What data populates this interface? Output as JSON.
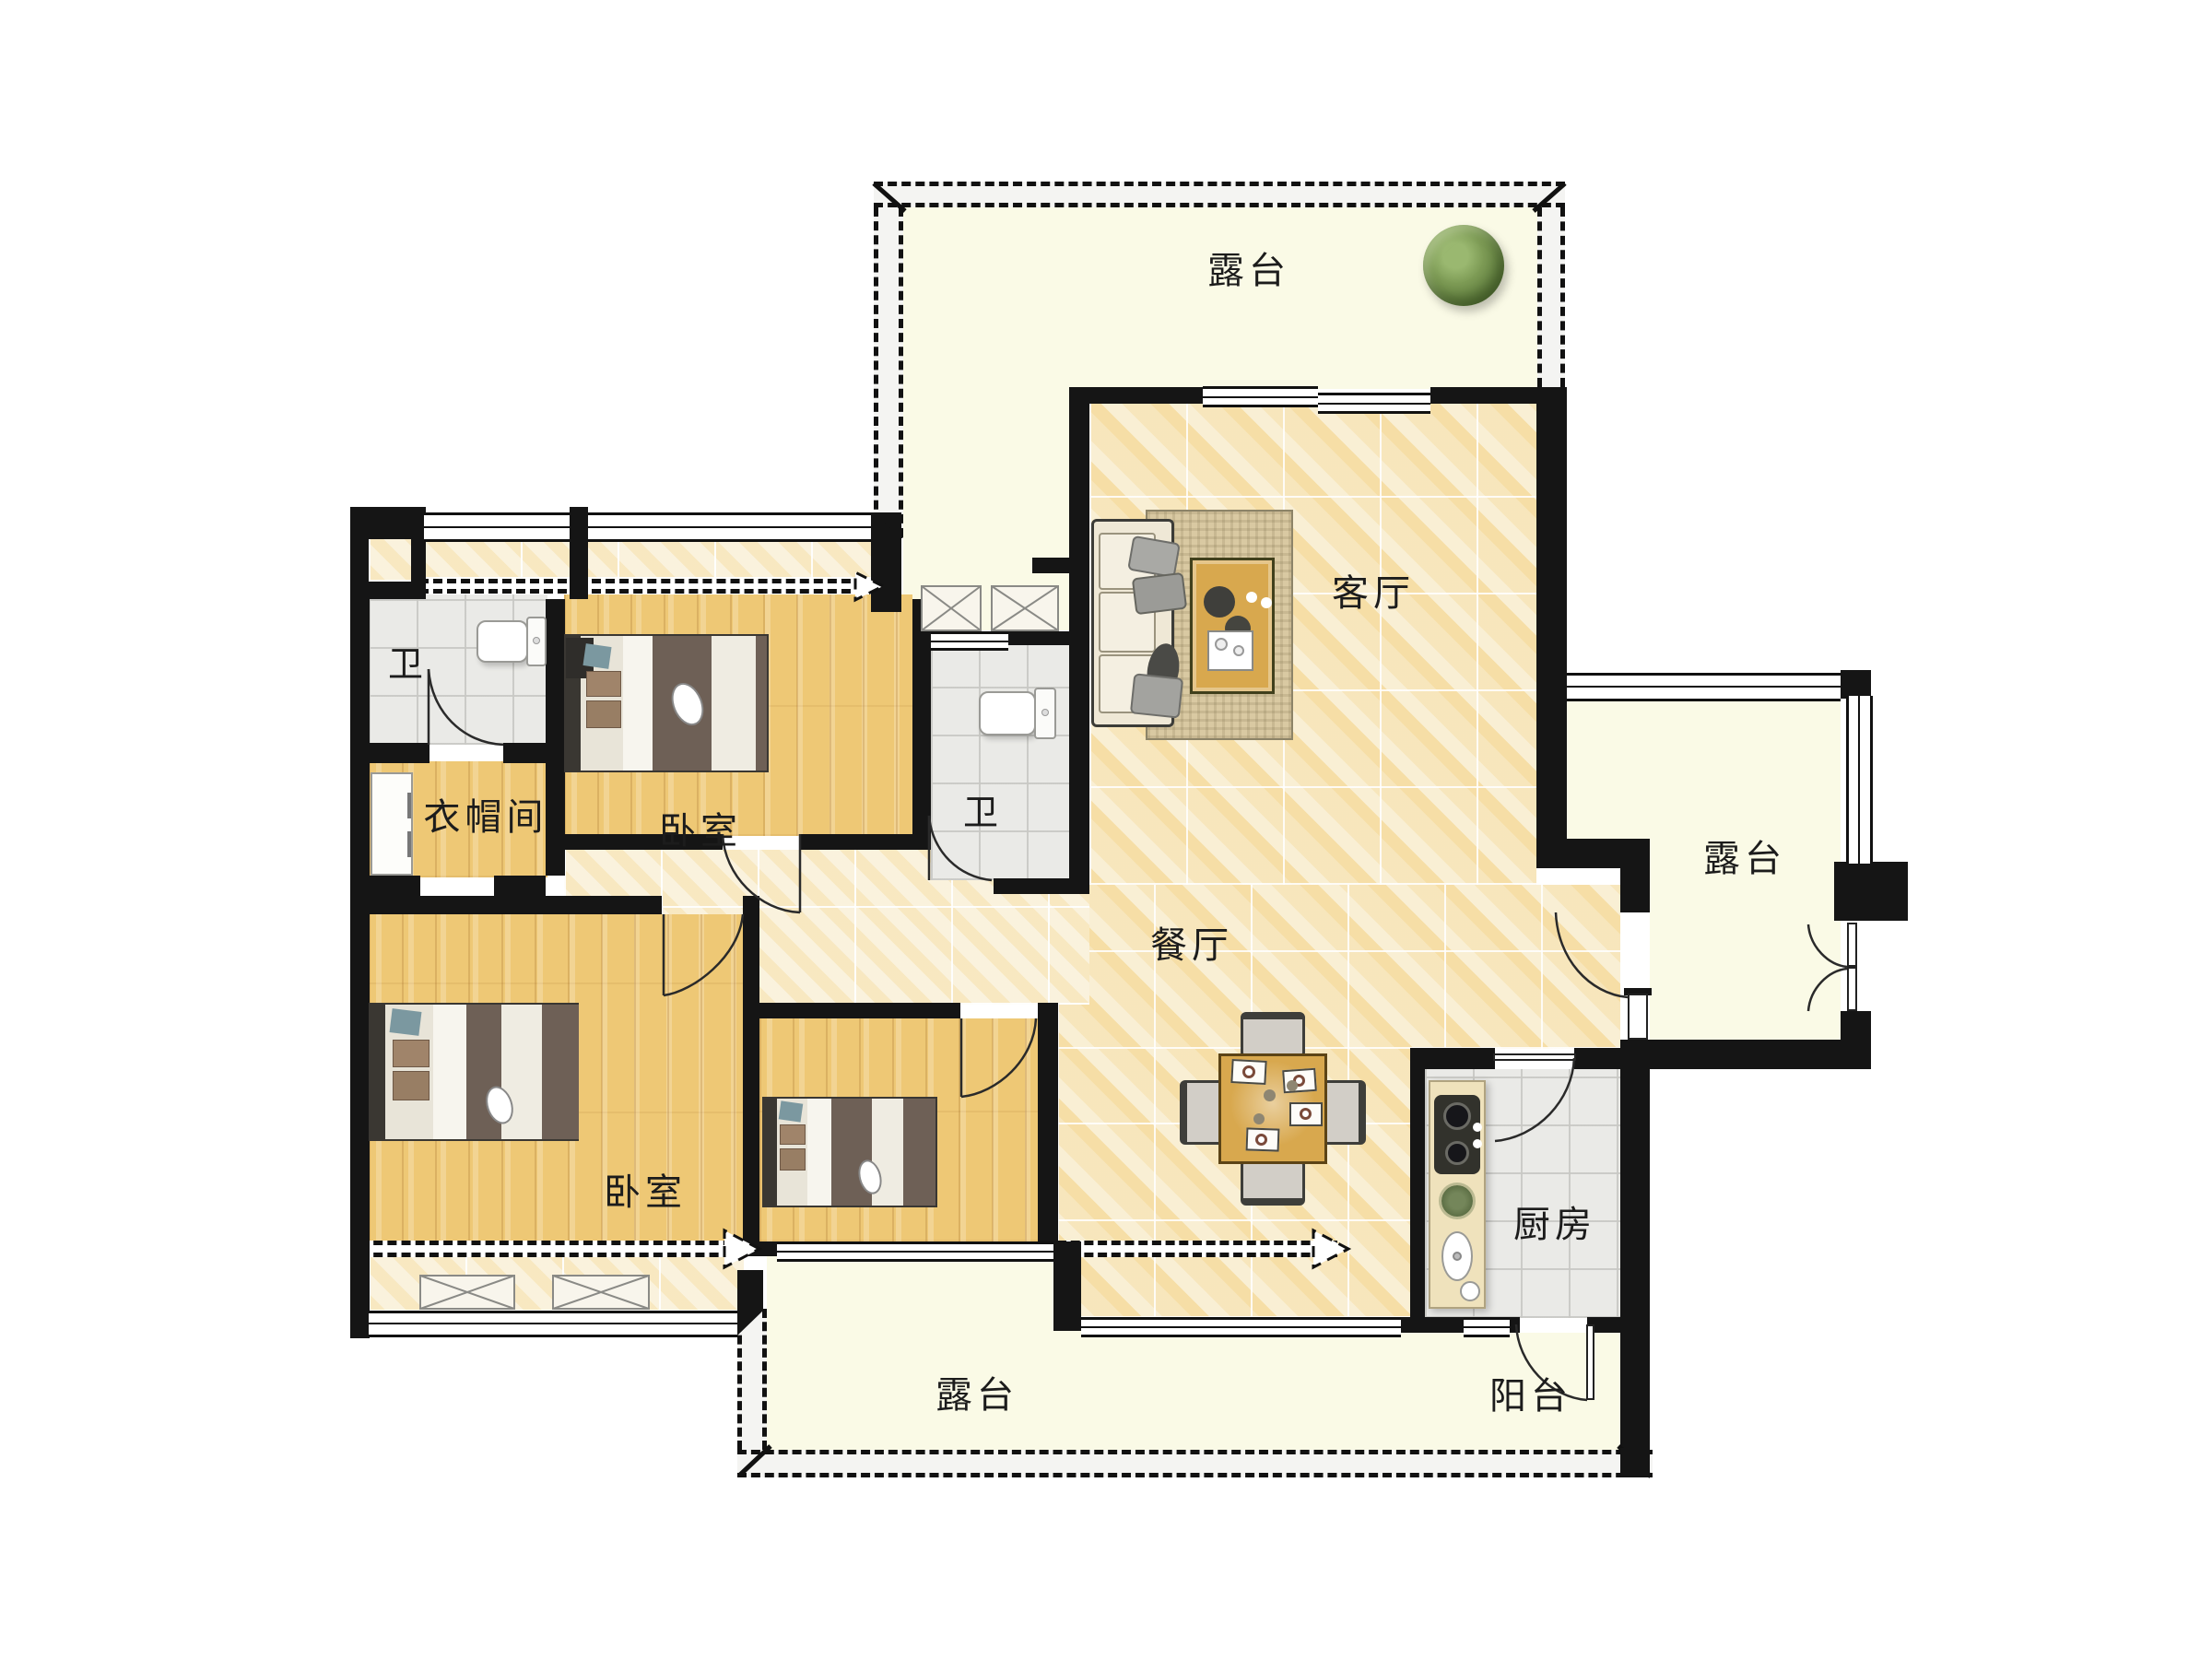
{
  "document": {
    "type": "residential floor plan",
    "language": "zh-CN"
  },
  "rooms": {
    "terrace_top": {
      "label": "露台"
    },
    "terrace_right": {
      "label": "露台"
    },
    "terrace_bottom": {
      "label": "露台"
    },
    "living": {
      "label": "客厅"
    },
    "dining": {
      "label": "餐厅"
    },
    "bedroom_top": {
      "label": "卧室"
    },
    "bedroom_main": {
      "label": "卧室"
    },
    "cloakroom": {
      "label": "衣帽间"
    },
    "bath_top": {
      "label": "卫"
    },
    "bath_mid": {
      "label": "卫"
    },
    "kitchen": {
      "label": "厨房"
    },
    "balcony": {
      "label": "阳台"
    }
  },
  "colors": {
    "wall": "#151515",
    "marble_floor": "#f7e9c4",
    "wood_floor": "#eec875",
    "gray_tile": "#eaeae7",
    "terrace_fill": "#fafae6",
    "table_wood": "#d8a84e",
    "blanket": "#6e6056",
    "plant_green": "#7d9b55"
  },
  "icons": [
    "plant-icon",
    "sofa-icon",
    "coffee-table-icon",
    "dining-table-icon",
    "bed-icon",
    "toilet-icon",
    "wardrobe-icon",
    "stove-sink-icon",
    "door-swing-icon",
    "window-icon",
    "ac-platform-icon",
    "entry-arrow-icon"
  ]
}
